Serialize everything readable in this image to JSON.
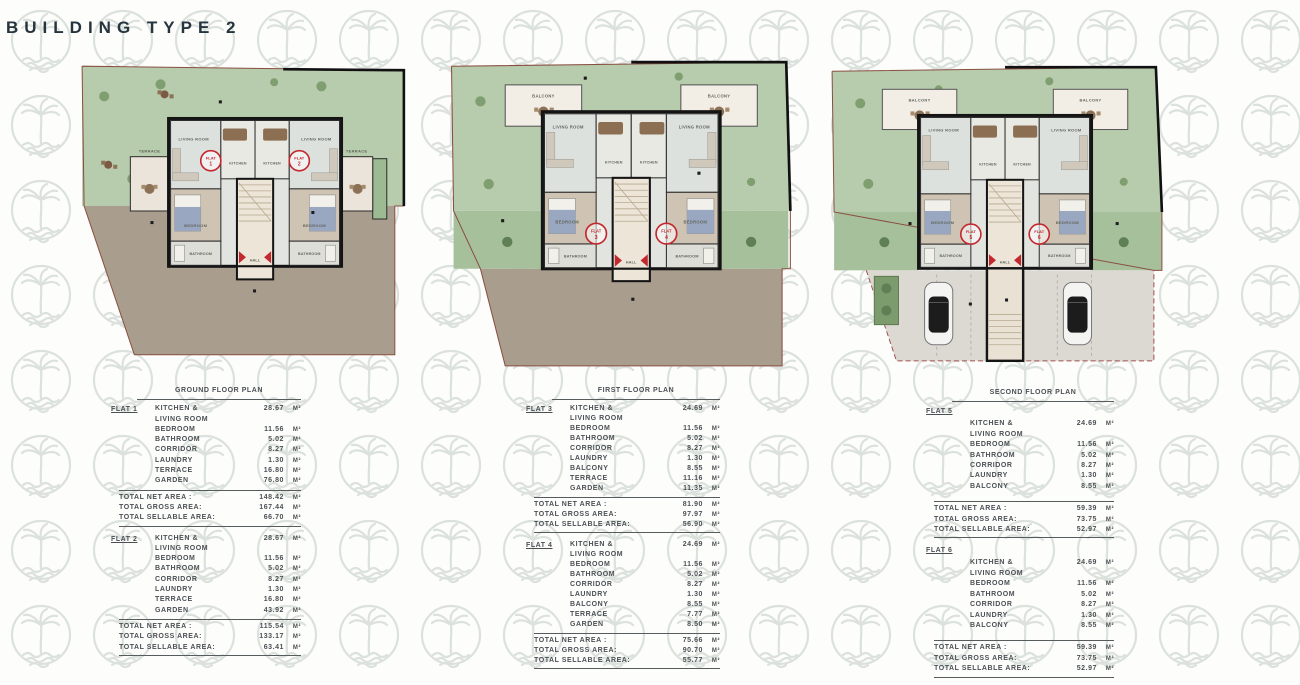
{
  "title": "BUILDING TYPE 2",
  "m2_label": "M²",
  "colors": {
    "title_text": "#26343d",
    "garden_green": "#b7cbad",
    "side_garden_green": "#a7c09c",
    "soil_brown": "#a99d8e",
    "parking_grey": "#dcd9d3",
    "terrace_cream": "#ebe4db",
    "wall_black": "#141414",
    "flat_circle_red": "#c3282e",
    "plot_boundary": "#8a4f41",
    "watermark_grey": "#d9dfda",
    "table_text": "#4b5054"
  },
  "watermark_icon": "palm-tree-logo",
  "plans": [
    {
      "name": "ground-floor-plan",
      "labels": {
        "terrace": "TERRACE",
        "living": "LIVING ROOM",
        "kitchen": "KITCHEN",
        "bedroom": "BEDROOM",
        "bathroom": "BATHROOM",
        "hall": "HALL"
      },
      "flats": [
        {
          "word": "FLAT",
          "num": "1"
        },
        {
          "word": "FLAT",
          "num": "2"
        }
      ]
    },
    {
      "name": "first-floor-plan",
      "labels": {
        "balcony": "BALCONY",
        "living": "LIVING ROOM",
        "kitchen": "KITCHEN",
        "bedroom": "BEDROOM",
        "bathroom": "BATHROOM",
        "hall": "HALL"
      },
      "flats": [
        {
          "word": "FLAT",
          "num": "3"
        },
        {
          "word": "FLAT",
          "num": "4"
        }
      ]
    },
    {
      "name": "second-floor-plan",
      "labels": {
        "balcony": "BALCONY",
        "living": "LIVING ROOM",
        "kitchen": "KITCHEN",
        "bedroom": "BEDROOM",
        "bathroom": "BATHROOM",
        "hall": "HALL"
      },
      "flats": [
        {
          "word": "FLAT",
          "num": "5"
        },
        {
          "word": "FLAT",
          "num": "6"
        }
      ]
    }
  ],
  "tables": [
    {
      "heading": "GROUND FLOOR PLAN",
      "sections": [
        {
          "flat": "FLAT 1",
          "rows": [
            {
              "label": "KITCHEN &\nLIVING ROOM",
              "value": "28.67"
            },
            {
              "label": "BEDROOM",
              "value": "11.56"
            },
            {
              "label": "BATHROOM",
              "value": "5.02"
            },
            {
              "label": "CORRIDOR",
              "value": "8.27"
            },
            {
              "label": "LAUNDRY",
              "value": "1.30"
            },
            {
              "label": "TERRACE",
              "value": "16.80"
            },
            {
              "label": "GARDEN",
              "value": "76.80"
            }
          ],
          "totals": [
            {
              "label": "TOTAL NET AREA :",
              "value": "148.42"
            },
            {
              "label": "TOTAL GROSS AREA:",
              "value": "167.44"
            },
            {
              "label": "TOTAL SELLABLE AREA:",
              "value": "66.70"
            }
          ]
        },
        {
          "flat": "FLAT 2",
          "rows": [
            {
              "label": "KITCHEN &\nLIVING ROOM",
              "value": "28.67"
            },
            {
              "label": "BEDROOM",
              "value": "11.56"
            },
            {
              "label": "BATHROOM",
              "value": "5.02"
            },
            {
              "label": "CORRIDOR",
              "value": "8.27"
            },
            {
              "label": "LAUNDRY",
              "value": "1.30"
            },
            {
              "label": "TERRACE",
              "value": "16.80"
            },
            {
              "label": "GARDEN",
              "value": "43.92"
            }
          ],
          "totals": [
            {
              "label": "TOTAL NET AREA :",
              "value": "115.54"
            },
            {
              "label": "TOTAL GROSS AREA:",
              "value": "133.17"
            },
            {
              "label": "TOTAL SELLABLE AREA:",
              "value": "63.41"
            }
          ]
        }
      ]
    },
    {
      "heading": "FIRST FLOOR PLAN",
      "sections": [
        {
          "flat": "FLAT 3",
          "rows": [
            {
              "label": "KITCHEN &\nLIVING ROOM",
              "value": "24.69"
            },
            {
              "label": "BEDROOM",
              "value": "11.56"
            },
            {
              "label": "BATHROOM",
              "value": "5.02"
            },
            {
              "label": "CORRIDOR",
              "value": "8.27"
            },
            {
              "label": "LAUNDRY",
              "value": "1.30"
            },
            {
              "label": "BALCONY",
              "value": "8.55"
            },
            {
              "label": "TERRACE",
              "value": "11.16"
            },
            {
              "label": "GARDEN",
              "value": "11.35"
            }
          ],
          "totals": [
            {
              "label": "TOTAL NET AREA :",
              "value": "81.90"
            },
            {
              "label": "TOTAL GROSS AREA:",
              "value": "97.97"
            },
            {
              "label": "TOTAL SELLABLE AREA:",
              "value": "56.90"
            }
          ]
        },
        {
          "flat": "FLAT 4",
          "rows": [
            {
              "label": "KITCHEN &\nLIVING ROOM",
              "value": "24.69"
            },
            {
              "label": "BEDROOM",
              "value": "11.56"
            },
            {
              "label": "BATHROOM",
              "value": "5.02"
            },
            {
              "label": "CORRIDOR",
              "value": "8.27"
            },
            {
              "label": "LAUNDRY",
              "value": "1.30"
            },
            {
              "label": "BALCONY",
              "value": "8.55"
            },
            {
              "label": "TERRACE",
              "value": "7.77"
            },
            {
              "label": "GARDEN",
              "value": "8.50"
            }
          ],
          "totals": [
            {
              "label": "TOTAL NET AREA :",
              "value": "75.66"
            },
            {
              "label": "TOTAL GROSS AREA:",
              "value": "90.70"
            },
            {
              "label": "TOTAL SELLABLE AREA:",
              "value": "55.77"
            }
          ]
        }
      ]
    },
    {
      "heading": "SECOND FLOOR PLAN",
      "sections": [
        {
          "flat": "FLAT 5",
          "rows": [
            {
              "label": "KITCHEN &\nLIVING ROOM",
              "value": "24.69"
            },
            {
              "label": "BEDROOM",
              "value": "11.56"
            },
            {
              "label": "BATHROOM",
              "value": "5.02"
            },
            {
              "label": "CORRIDOR",
              "value": "8.27"
            },
            {
              "label": "LAUNDRY",
              "value": "1.30"
            },
            {
              "label": "BALCONY",
              "value": "8.55"
            }
          ],
          "totals": [
            {
              "label": "TOTAL NET AREA :",
              "value": "59.39"
            },
            {
              "label": "TOTAL GROSS AREA:",
              "value": "73.75"
            },
            {
              "label": "TOTAL SELLABLE AREA:",
              "value": "52.97"
            }
          ]
        },
        {
          "flat": "FLAT 6",
          "rows": [
            {
              "label": "KITCHEN &\nLIVING ROOM",
              "value": "24.69"
            },
            {
              "label": "BEDROOM",
              "value": "11.56"
            },
            {
              "label": "BATHROOM",
              "value": "5.02"
            },
            {
              "label": "CORRIDOR",
              "value": "8.27"
            },
            {
              "label": "LAUNDRY",
              "value": "1.30"
            },
            {
              "label": "BALCONY",
              "value": "8.55"
            }
          ],
          "totals": [
            {
              "label": "TOTAL NET AREA :",
              "value": "59.39"
            },
            {
              "label": "TOTAL GROSS AREA:",
              "value": "73.75"
            },
            {
              "label": "TOTAL SELLABLE AREA:",
              "value": "52.97"
            }
          ]
        }
      ]
    }
  ]
}
